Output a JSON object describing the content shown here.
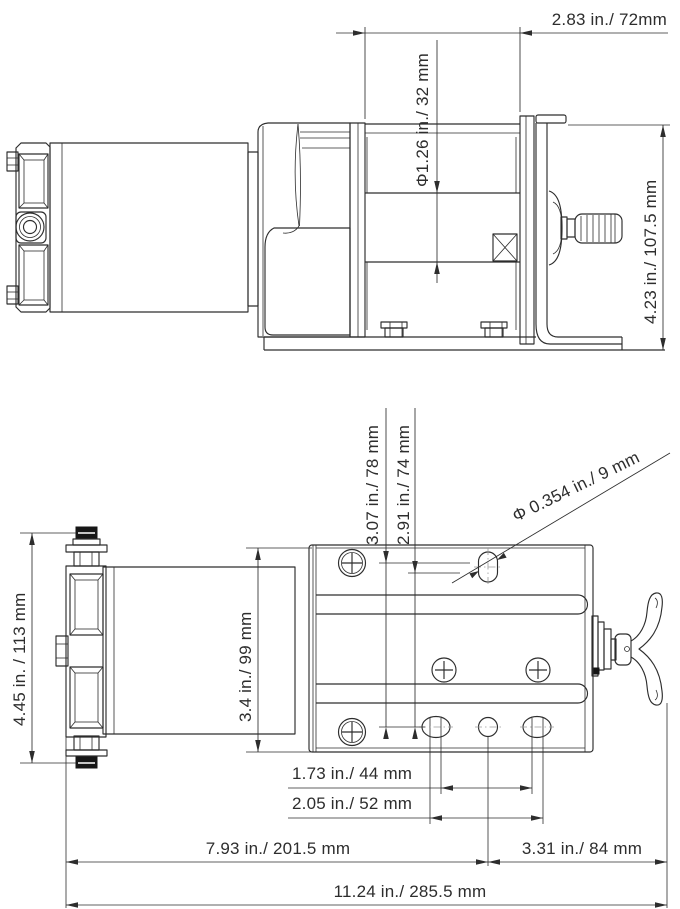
{
  "colors": {
    "line": "#2d2d2d",
    "centerline": "#9a9a9a",
    "background": "#ffffff"
  },
  "side_view": {
    "dims": {
      "drum_length": "2.83 in./ 72mm",
      "drum_diameter": "Φ1.26 in./ 32 mm",
      "overall_height": "4.23 in./ 107.5 mm"
    }
  },
  "plan_view": {
    "dims": {
      "motor_assembly_height": "4.45 in. / 113 mm",
      "drum_body_width": "3.4 in./ 99 mm",
      "hole_offset_outer": "3.07 in./ 78 mm",
      "hole_offset_inner": "2.91 in./ 74 mm",
      "mount_hole_diameter": "Φ 0.354 in./ 9 mm",
      "slot_spacing_inner": "1.73 in./ 44 mm",
      "slot_spacing_outer": "2.05 in./ 52 mm",
      "left_to_hole_center": "7.93 in./ 201.5 mm",
      "hole_center_to_right": "3.31 in./ 84 mm",
      "overall_length": "11.24 in./ 285.5 mm"
    }
  }
}
